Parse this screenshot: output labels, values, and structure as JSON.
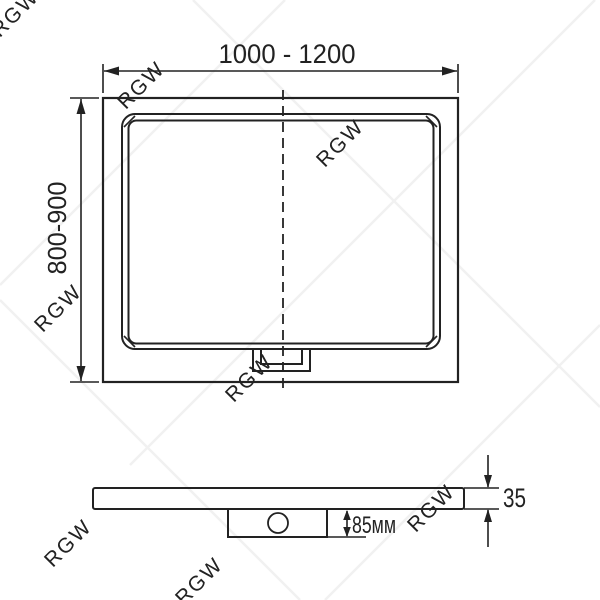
{
  "drawing": {
    "title": "Shower tray technical drawing",
    "colors": {
      "line": "#222222",
      "background": "#ffffff",
      "watermark_line": "#f1f1f1",
      "watermark_text": "#e9e9e9",
      "watermark_text_strong": "#c9c9c9"
    },
    "top_view": {
      "width_label": "1000 - 1200",
      "height_label": "800-900"
    },
    "side_view": {
      "thickness_label": "35",
      "drain_depth_label": "85мм"
    },
    "watermark": {
      "text": "RGW"
    }
  }
}
